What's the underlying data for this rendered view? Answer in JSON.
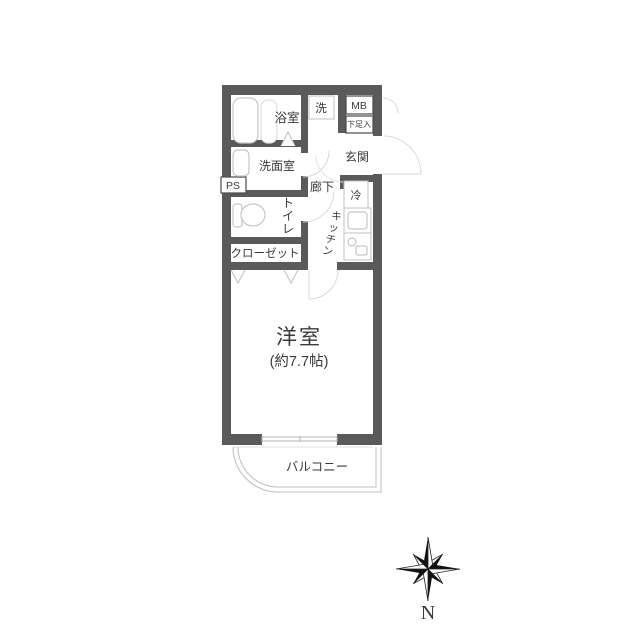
{
  "floorplan": {
    "labels": {
      "bathroom": "浴室",
      "washing_machine": "洗",
      "meter_box": "MB",
      "shoe_box": "下足入",
      "entrance": "玄関",
      "washroom": "洗面室",
      "pipe_space": "PS",
      "hallway": "廊下",
      "refrigerator": "冷",
      "toilet": "トイレ",
      "kitchen": "キッチン",
      "closet": "クローゼット",
      "main_room": "洋室",
      "main_room_size": "(約7.7帖)",
      "balcony": "バルコニー"
    },
    "compass": {
      "north": "N"
    },
    "colors": {
      "wall": "#5a5a5a",
      "thin_line": "#c0c0c0",
      "text": "#3a3a3a",
      "compass": "#111111"
    }
  }
}
